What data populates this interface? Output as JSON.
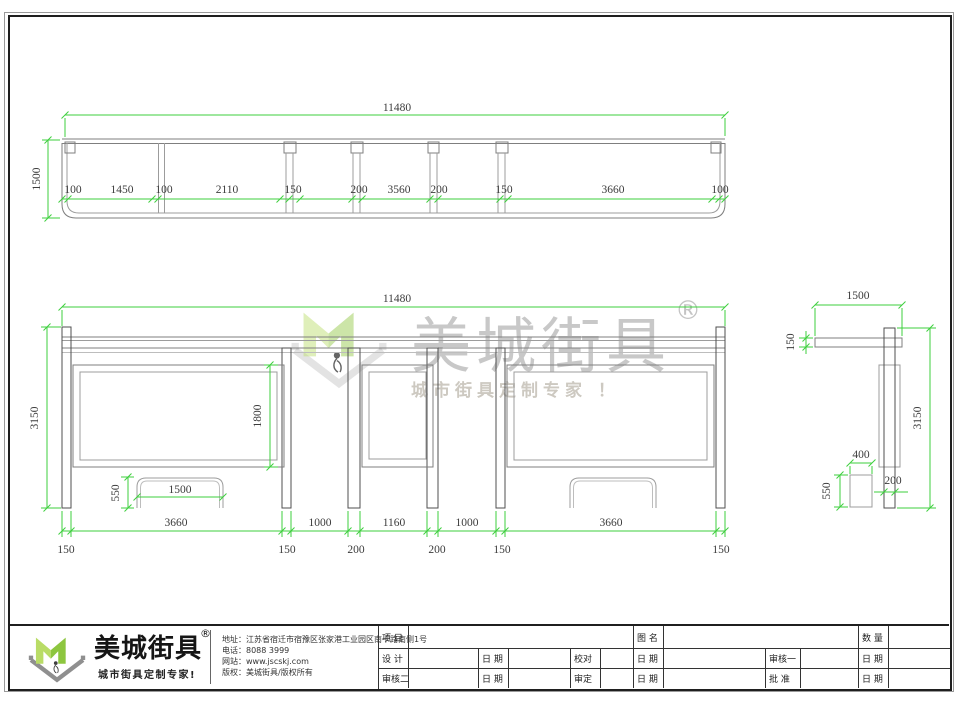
{
  "top_view": {
    "label_overall": "11480",
    "label_depth": "1500",
    "chain": [
      "100",
      "1450",
      "100",
      "2110",
      "150",
      "200",
      "3560",
      "200",
      "150",
      "3660",
      "100"
    ]
  },
  "front_view": {
    "label_overall": "11480",
    "label_height": "3150",
    "label_panel_height": "1800",
    "label_bench_height": "550",
    "label_bench_width": "1500",
    "bays": [
      "3660",
      "1000",
      "1160",
      "1000",
      "3660"
    ],
    "posts": [
      "150",
      "150",
      "200",
      "200",
      "150",
      "150"
    ]
  },
  "side_view": {
    "label_width": "1500",
    "label_roof_thickness": "150",
    "label_height": "3150",
    "label_bench_depth": "400",
    "label_bench_height": "550",
    "label_post": "200"
  },
  "watermark": {
    "brand": "美城街具",
    "registered": "®",
    "slogan": "城市街具定制专家 ！"
  },
  "footer": {
    "brand": "美城街具",
    "registered": "®",
    "slogan": "城市街具定制专家!",
    "contact_lines": [
      "地址：江苏省宿迁市宿豫区张家港工业园区南卡路南侧1号",
      "电话：8088 3999",
      "网站：www.jscskj.com",
      "版权：美城街具/版权所有"
    ],
    "table": {
      "project": "项 目",
      "drawing_name": "图 名",
      "quantity": "数 量",
      "design": "设 计",
      "date": "日 期",
      "proofread": "校对",
      "review1": "审核一",
      "review2": "审核二",
      "approve": "审定",
      "ratify": "批 准"
    }
  },
  "colors": {
    "dimension_green": "#3ecf3e",
    "logo_green": "#8dc63f",
    "logo_light_green": "#b9dc66"
  }
}
